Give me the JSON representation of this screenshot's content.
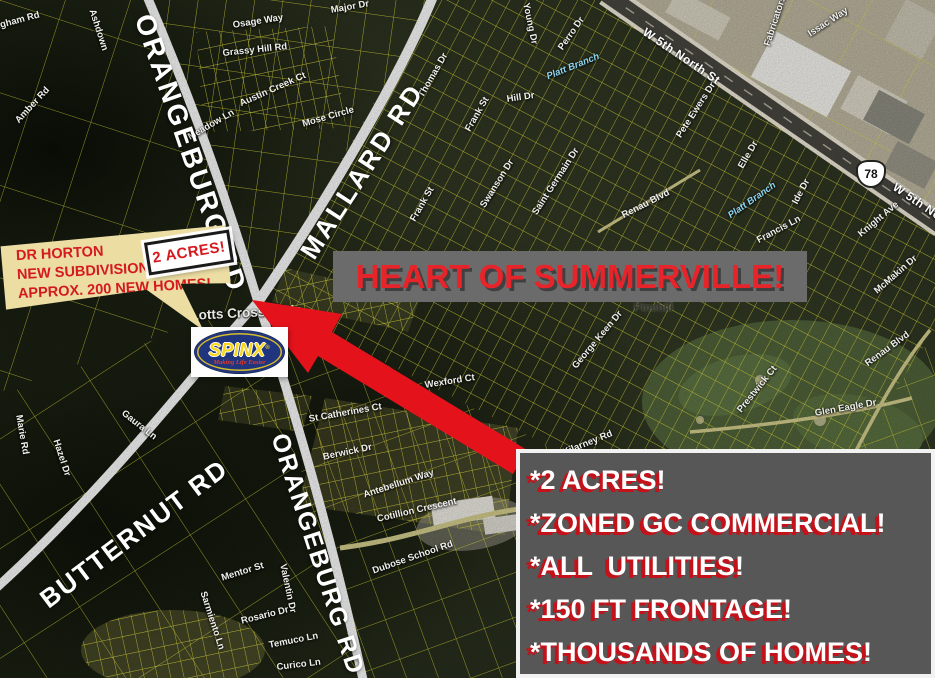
{
  "flyer": {
    "banner": "HEART OF SUMMERVILLE!",
    "acreage_tag": "2 ACRES!",
    "callout_lines": [
      "DR HORTON",
      "NEW SUBDIVISION!",
      "APPROX. 200 NEW HOMES!"
    ],
    "logo": {
      "name": "SPINX",
      "reg": "®",
      "tagline": "Making Life Easier"
    },
    "bullet_lines": [
      "*2 ACRES!",
      "*ZONED GC COMMERCIAL!",
      "*ALL  UTILITIES!",
      "*150 FT FRONTAGE!",
      "*THOUSANDS OF HOMES!"
    ]
  },
  "map": {
    "highway_shield": "78",
    "road_labels": [
      {
        "text": "ORANGEBURG RD",
        "x": 158,
        "y": 10,
        "rot": 71,
        "size": 28,
        "ls": 3
      },
      {
        "text": "MALLARD RD",
        "x": 294,
        "y": 248,
        "rot": -57,
        "size": 26,
        "ls": 3
      },
      {
        "text": "BUTTERNUT RD",
        "x": 34,
        "y": 590,
        "rot": -37,
        "size": 26,
        "ls": 2
      },
      {
        "text": "ORANGEBURG RD",
        "x": 292,
        "y": 430,
        "rot": 72,
        "size": 25,
        "ls": 2
      }
    ],
    "street_labels": [
      {
        "t": "Bingham Rd",
        "x": -16,
        "y": 24,
        "r": -15
      },
      {
        "t": "Osage Way",
        "x": 232,
        "y": 20,
        "r": -9
      },
      {
        "t": "Grassy Hill Rd",
        "x": 222,
        "y": 48,
        "r": -6
      },
      {
        "t": "Austin Creek Ct",
        "x": 238,
        "y": 99,
        "r": -24
      },
      {
        "t": "Meadow Ln",
        "x": 186,
        "y": 133,
        "r": -30
      },
      {
        "t": "Mose Circle",
        "x": 301,
        "y": 119,
        "r": -16
      },
      {
        "t": "Amber Rd",
        "x": 13,
        "y": 118,
        "r": -47
      },
      {
        "t": "Ashdown",
        "x": 97,
        "y": 8,
        "r": 72
      },
      {
        "t": "Major Dr",
        "x": 330,
        "y": 5,
        "r": -10
      },
      {
        "t": "Thomas Dr",
        "x": 416,
        "y": 94,
        "r": -60
      },
      {
        "t": "Frank St",
        "x": 463,
        "y": 128,
        "r": -60
      },
      {
        "t": "Frank St",
        "x": 408,
        "y": 218,
        "r": -60
      },
      {
        "t": "Hill Dr",
        "x": 506,
        "y": 94,
        "r": -8
      },
      {
        "t": "Swanson Dr",
        "x": 478,
        "y": 204,
        "r": -58
      },
      {
        "t": "Saint Germain Dr",
        "x": 530,
        "y": 211,
        "r": -57
      },
      {
        "t": "Young Dr",
        "x": 531,
        "y": 2,
        "r": 78
      },
      {
        "t": "Perro Dr",
        "x": 556,
        "y": 46,
        "r": -55
      },
      {
        "t": "Platt Branch",
        "x": 545,
        "y": 72,
        "r": -22,
        "s": "water"
      },
      {
        "t": "Platt Branch",
        "x": 726,
        "y": 212,
        "r": -35,
        "s": "water"
      },
      {
        "t": "W 5th North St",
        "x": 648,
        "y": 25,
        "r": 34,
        "s": "hwy"
      },
      {
        "t": "W 5th North St",
        "x": 898,
        "y": 180,
        "r": 34,
        "s": "hwy"
      },
      {
        "t": "Issac Way",
        "x": 806,
        "y": 30,
        "r": -33
      },
      {
        "t": "Fabricators",
        "x": 762,
        "y": 44,
        "r": -72
      },
      {
        "t": "Pete Ewers Dr",
        "x": 674,
        "y": 134,
        "r": -57
      },
      {
        "t": "Elle Dr",
        "x": 736,
        "y": 165,
        "r": -60
      },
      {
        "t": "Ide Dr",
        "x": 790,
        "y": 201,
        "r": -62
      },
      {
        "t": "Renau Blvd",
        "x": 620,
        "y": 211,
        "r": -27
      },
      {
        "t": "Renau Blvd",
        "x": 863,
        "y": 360,
        "r": -36
      },
      {
        "t": "Knight Ave",
        "x": 856,
        "y": 231,
        "r": -40
      },
      {
        "t": "McMakin Dr",
        "x": 872,
        "y": 288,
        "r": -41
      },
      {
        "t": "Francis Ln",
        "x": 755,
        "y": 236,
        "r": -28
      },
      {
        "t": "Pinehill",
        "x": 634,
        "y": 302,
        "r": 0,
        "s": "place"
      },
      {
        "t": "George Keen Dr",
        "x": 570,
        "y": 364,
        "r": -50
      },
      {
        "t": "Kilarney Rd",
        "x": 561,
        "y": 448,
        "r": -22
      },
      {
        "t": "Prestwick Ct",
        "x": 735,
        "y": 408,
        "r": -51
      },
      {
        "t": "Glen Eagle Dr",
        "x": 814,
        "y": 408,
        "r": -10
      },
      {
        "t": "Marie Rd",
        "x": 24,
        "y": 414,
        "r": 80
      },
      {
        "t": "Hazel Dr",
        "x": 61,
        "y": 438,
        "r": 72
      },
      {
        "t": "Gaura Ln",
        "x": 126,
        "y": 408,
        "r": 38
      },
      {
        "t": "St Catherines Ct",
        "x": 308,
        "y": 414,
        "r": -10
      },
      {
        "t": "Wexford Ct",
        "x": 424,
        "y": 380,
        "r": -9
      },
      {
        "t": "Berwick Dr",
        "x": 322,
        "y": 452,
        "r": -12
      },
      {
        "t": "Antebellum Way",
        "x": 362,
        "y": 490,
        "r": -18
      },
      {
        "t": "Cotillion Crescent",
        "x": 376,
        "y": 514,
        "r": -13
      },
      {
        "t": "Mentor St",
        "x": 220,
        "y": 573,
        "r": -17
      },
      {
        "t": "Sarmiento Ln",
        "x": 208,
        "y": 590,
        "r": 72
      },
      {
        "t": "Rosario Dr",
        "x": 240,
        "y": 616,
        "r": -14
      },
      {
        "t": "Valentin Dr",
        "x": 288,
        "y": 563,
        "r": 78
      },
      {
        "t": "Temuco Ln",
        "x": 268,
        "y": 640,
        "r": -11
      },
      {
        "t": "Curico Ln",
        "x": 276,
        "y": 662,
        "r": -7
      },
      {
        "t": "Dubose School Rd",
        "x": 371,
        "y": 566,
        "r": -19
      },
      {
        "t": "Lotts Crossroads",
        "x": 190,
        "y": 308,
        "r": -3,
        "s": "place2"
      }
    ]
  },
  "colors": {
    "arrow": "#e4131b",
    "banner_bg": "#6b6b6b",
    "banner_text": "#e8242b",
    "box_bg": "#575757",
    "box_text_shadow": "#c3121a",
    "parcel_line": "#e7e33b",
    "callout_bg": "#ecdda3",
    "callout_text": "#d41a20",
    "logo_blue": "#21357f",
    "logo_yellow": "#f7d517"
  }
}
